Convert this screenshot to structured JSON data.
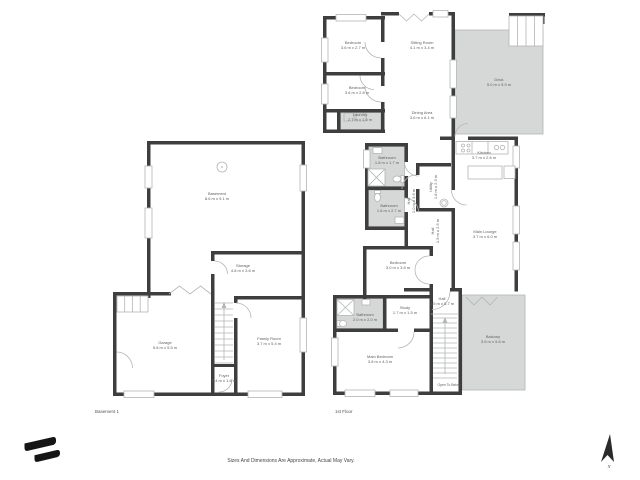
{
  "colors": {
    "wall": "#3e3e3e",
    "shaded": "#d6d8d7",
    "line": "#b3b6b5",
    "text": "#5f5f5f",
    "ink": "#1a1a1a"
  },
  "footer": {
    "disclaimer": "Sizes And Dimensions Are Approximate, Actual May Vary.",
    "compass_label": "N"
  },
  "basement": {
    "label": "Basement 1",
    "rooms": {
      "basement": {
        "name": "Basement",
        "dims": "8.6 m x 9.1 m"
      },
      "storage": {
        "name": "Storage",
        "dims": "4.8 m x 3.6 m"
      },
      "garage": {
        "name": "Garage",
        "dims": "5.8 m x 5.5 m"
      },
      "family_room": {
        "name": "Family Room",
        "dims": "3.7 m x 5.4 m"
      },
      "foyer": {
        "name": "Foyer",
        "dims": "1.4 m x 1.6 m"
      }
    }
  },
  "first_floor": {
    "label": "1st Floor",
    "rooms": {
      "bedroom1": {
        "name": "Bedroom",
        "dims": "3.6 m x 2.7 m"
      },
      "bedroom2": {
        "name": "Bedroom",
        "dims": "3.6 m x 2.8 m"
      },
      "laundry": {
        "name": "Laundry",
        "dims": "2.7 m x 1.6 m"
      },
      "sitting_room": {
        "name": "Sitting Room",
        "dims": "4.1 m x 3.4 m"
      },
      "dining_area": {
        "name": "Dining Area",
        "dims": "3.6 m x 6.1 m"
      },
      "deck": {
        "name": "Deck",
        "dims": "5.0 m x 5.9 m"
      },
      "kitchen": {
        "name": "Kitchen",
        "dims": "3.7 m x 2.6 m"
      },
      "main_lounge": {
        "name": "Main Lounge",
        "dims": "3.7 m x 6.0 m"
      },
      "bathroom1": {
        "name": "Bathroom",
        "dims": "1.8 m x 1.7 m"
      },
      "bathroom2": {
        "name": "Bathroom",
        "dims": "1.6 m x 2.7 m"
      },
      "utility": {
        "name": "Utility",
        "dims": "1.8 m x 2.3 m"
      },
      "hall1": {
        "name": "Hall",
        "dims": "1.0 m x 3.6 m"
      },
      "hall2": {
        "name": "Hall",
        "dims": "1.9 m x 2.5 m"
      },
      "bedroom3": {
        "name": "Bedroom",
        "dims": "3.0 m x 3.6 m"
      },
      "hall3": {
        "name": "Hall",
        "dims": "2.5 m x 5.7 m"
      },
      "study": {
        "name": "Study",
        "dims": "1.7 m x 1.5 m"
      },
      "bathroom3": {
        "name": "Bathroom",
        "dims": "2.0 m x 2.0 m"
      },
      "main_bedroom": {
        "name": "Main Bedroom",
        "dims": "3.8 m x 4.3 m"
      },
      "balcony": {
        "name": "Balcony",
        "dims": "3.5 m x 5.6 m"
      },
      "open_to_below": {
        "name": "Open To Below"
      }
    }
  }
}
